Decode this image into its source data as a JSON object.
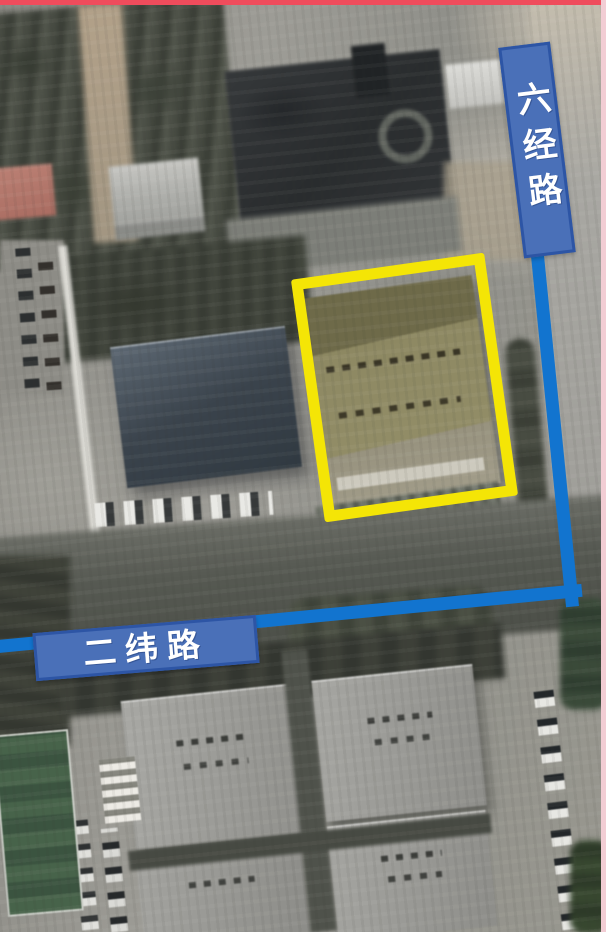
{
  "colors": {
    "highlight": "#f4e506",
    "road_line": "#1274cf",
    "label_fill": "#4a70b8",
    "label_border": "#2d55a5",
    "top_border": "#ef4c5c",
    "right_border": "#f2cdd4"
  },
  "roads": [
    {
      "label": "六经路",
      "orientation": "vertical"
    },
    {
      "label": "二纬路",
      "orientation": "horizontal"
    }
  ],
  "highlight": {
    "shape": "rectangle",
    "color_name": "yellow"
  }
}
